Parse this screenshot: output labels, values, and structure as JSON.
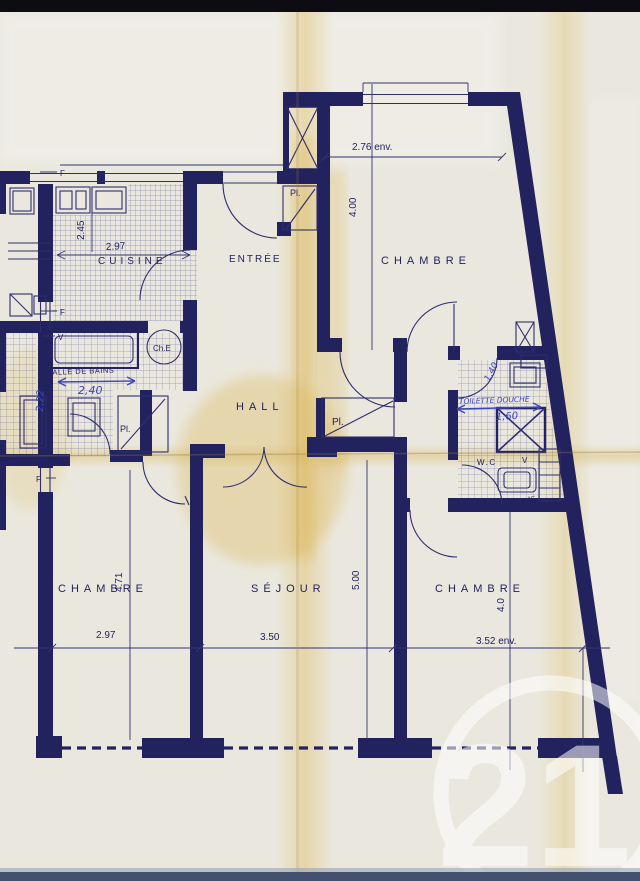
{
  "document": {
    "kind": "apartment floor plan (scanned blueprint)",
    "watermark": "21"
  },
  "palette": {
    "paper": "#eae8de",
    "ink": "#22225f",
    "handwritten_ink": "#3946c0",
    "stain": "#dfbd63"
  },
  "rooms": {
    "cuisine": {
      "label": "CUISINE",
      "width": "2.97",
      "depth": "2.45"
    },
    "entree": {
      "label": "ENTRÉE"
    },
    "chambre_top": {
      "label": "CHAMBRE",
      "width": "2.76 env.",
      "depth": "4.00"
    },
    "salle_de_bains": {
      "label": "SALLE DE BAINS",
      "width": "2,40",
      "depth": "2,22"
    },
    "hall": {
      "label": "HALL"
    },
    "toilette_douche": {
      "label": "TOILETTE DOUCHE",
      "width": "1,60",
      "depth": "1,40"
    },
    "wc": {
      "label": "W.C"
    },
    "chambre_left": {
      "label": "CHAMBRE",
      "width": "2.97",
      "depth": "4.71"
    },
    "sejour": {
      "label": "SÉJOUR",
      "width": "3.50",
      "depth": "5.00"
    },
    "chambre_right": {
      "label": "CHAMBRE",
      "width": "3.52 env.",
      "depth": "4.0"
    }
  },
  "annotations": {
    "placard": "Pl.",
    "water_heater": "Ch.E",
    "window": "F",
    "vent": "V",
    "air_inlet": "AF"
  }
}
